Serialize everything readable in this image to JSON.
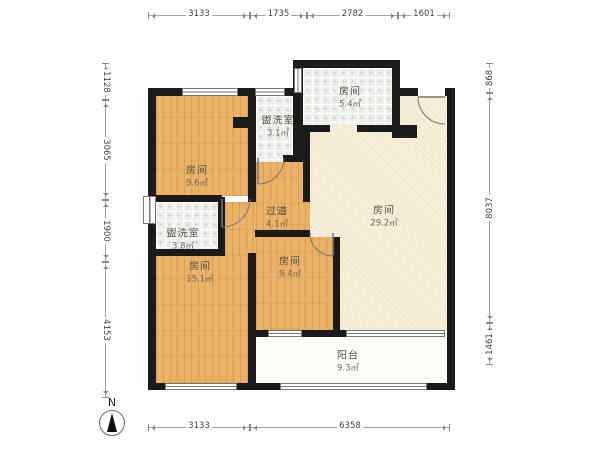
{
  "compass": {
    "label": "N"
  },
  "rooms": [
    {
      "name": "房间",
      "area": "9.6㎡",
      "cx": 197,
      "cy": 177
    },
    {
      "name": "盥洗室",
      "area": "3.1㎡",
      "cx": 278,
      "cy": 127
    },
    {
      "name": "房间",
      "area": "5.4㎡",
      "cx": 350,
      "cy": 98
    },
    {
      "name": "房间",
      "area": "29.2㎡",
      "cx": 384,
      "cy": 217
    },
    {
      "name": "过道",
      "area": "4.1㎡",
      "cx": 277,
      "cy": 218
    },
    {
      "name": "盥洗室",
      "area": "3.8㎡",
      "cx": 183,
      "cy": 240
    },
    {
      "name": "房间",
      "area": "15.1㎡",
      "cx": 200,
      "cy": 273
    },
    {
      "name": "房间",
      "area": "9.4㎡",
      "cx": 290,
      "cy": 268
    },
    {
      "name": "阳台",
      "area": "9.3㎡",
      "cx": 348,
      "cy": 362
    }
  ],
  "dimensions": {
    "top": {
      "y": 16,
      "segments": [
        {
          "label": "3133",
          "from": 148,
          "to": 250
        },
        {
          "label": "1735",
          "from": 250,
          "to": 307
        },
        {
          "label": "2782",
          "from": 307,
          "to": 398
        },
        {
          "label": "1601",
          "from": 398,
          "to": 450
        }
      ]
    },
    "bottom": {
      "y": 428,
      "segments": [
        {
          "label": "3133",
          "from": 148,
          "to": 250
        },
        {
          "label": "6358",
          "from": 250,
          "to": 450
        }
      ]
    },
    "left": {
      "x": 106,
      "segments": [
        {
          "label": "1128",
          "from": 63,
          "to": 100
        },
        {
          "label": "3065",
          "from": 100,
          "to": 200
        },
        {
          "label": "1900",
          "from": 200,
          "to": 262
        },
        {
          "label": "4153",
          "from": 262,
          "to": 398
        }
      ]
    },
    "right": {
      "x": 490,
      "segments": [
        {
          "label": "868",
          "from": 63,
          "to": 93
        },
        {
          "label": "8037",
          "from": 93,
          "to": 323
        },
        {
          "label": "1461",
          "from": 323,
          "to": 365
        }
      ]
    }
  },
  "colors": {
    "wall": "#1b1b1b",
    "wood_floor": "#eab167",
    "tile_floor": "#eceeea",
    "cream_floor": "#f6efda",
    "balcony_floor": "#fdfcf8",
    "dim_text": "#444444",
    "label_text": "#55504a"
  },
  "geometry": {
    "floors": [
      {
        "type": "cream",
        "rect": [
          310,
          96,
          137,
          234
        ]
      },
      {
        "type": "tile",
        "rect": [
          256,
          96,
          37,
          66
        ]
      },
      {
        "type": "tile",
        "rect": [
          303,
          68,
          89,
          57
        ]
      },
      {
        "type": "tile",
        "rect": [
          156,
          202,
          62,
          47
        ]
      },
      {
        "type": "wood",
        "rect": [
          156,
          96,
          92,
          100
        ]
      },
      {
        "type": "wood",
        "rect": [
          256,
          162,
          54,
          68
        ]
      },
      {
        "type": "wood",
        "rect": [
          225,
          202,
          31,
          54
        ]
      },
      {
        "type": "wood",
        "rect": [
          156,
          256,
          92,
          127
        ]
      },
      {
        "type": "wood",
        "rect": [
          256,
          237,
          77,
          93
        ]
      },
      {
        "type": "balcony",
        "rect": [
          256,
          337,
          191,
          46
        ]
      }
    ],
    "walls": [
      [
        148,
        88,
        8,
        302
      ],
      [
        148,
        88,
        152,
        8
      ],
      [
        293,
        60,
        10,
        102
      ],
      [
        295,
        60,
        105,
        8
      ],
      [
        392,
        60,
        8,
        78
      ],
      [
        392,
        125,
        25,
        13
      ],
      [
        395,
        88,
        23,
        8
      ],
      [
        445,
        88,
        10,
        8
      ],
      [
        447,
        88,
        8,
        302
      ],
      [
        148,
        383,
        17,
        7
      ],
      [
        237,
        383,
        43,
        7
      ],
      [
        427,
        383,
        28,
        7
      ],
      [
        248,
        96,
        8,
        106
      ],
      [
        148,
        195,
        74,
        7
      ],
      [
        283,
        155,
        17,
        7
      ],
      [
        300,
        125,
        30,
        7
      ],
      [
        357,
        125,
        40,
        7
      ],
      [
        303,
        132,
        7,
        70
      ],
      [
        218,
        197,
        7,
        59
      ],
      [
        148,
        249,
        77,
        7
      ],
      [
        248,
        253,
        8,
        137
      ],
      [
        255,
        230,
        55,
        7
      ],
      [
        333,
        237,
        7,
        100
      ],
      [
        256,
        330,
        12,
        7
      ],
      [
        302,
        330,
        44,
        7
      ],
      [
        390,
        330,
        8,
        7
      ],
      [
        233,
        117,
        15,
        11
      ]
    ],
    "windows": [
      {
        "rect": [
          182,
          88,
          56,
          8
        ],
        "dir": "h"
      },
      {
        "rect": [
          255,
          88,
          30,
          8
        ],
        "dir": "h"
      },
      {
        "rect": [
          294,
          68,
          8,
          25
        ],
        "dir": "v"
      },
      {
        "rect": [
          143,
          196,
          13,
          28
        ],
        "dir": "v"
      },
      {
        "rect": [
          165,
          383,
          72,
          7
        ],
        "dir": "h"
      },
      {
        "rect": [
          280,
          383,
          147,
          7
        ],
        "dir": "h"
      },
      {
        "rect": [
          268,
          330,
          34,
          7
        ],
        "dir": "h"
      },
      {
        "rect": [
          346,
          330,
          99,
          7
        ],
        "dir": "h"
      }
    ],
    "doors": [
      {
        "arc": "M418,97 A27,27 0 0 0 445,124",
        "leaf": "M418,97 L445,97"
      },
      {
        "arc": "M284,158 A26,26 0 0 1 258,184",
        "leaf": "M258,158 L258,184"
      },
      {
        "arc": "M250,199 A28,28 0 0 1 222,227",
        "leaf": "M222,199 L222,227"
      },
      {
        "arc": "M310,233 A23,23 0 0 0 333,256",
        "leaf": "M333,233 L333,256"
      }
    ]
  }
}
